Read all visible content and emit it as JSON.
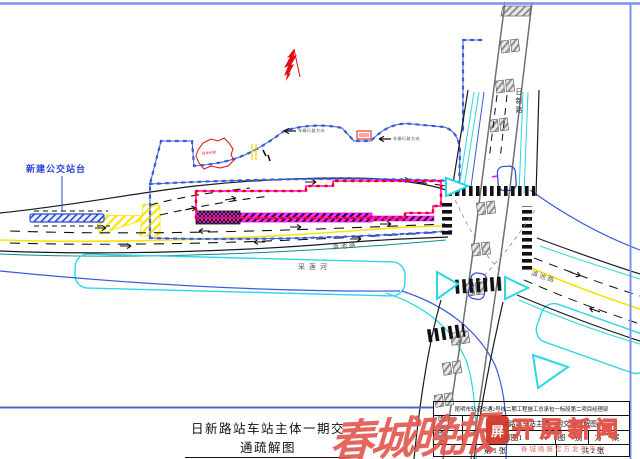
{
  "frame": {
    "border_color": "#7b93ea"
  },
  "annotations": {
    "bus_platform": "新建公交站台",
    "tree_note": "现状大树",
    "flow_note_1": "车辆行驶方向",
    "flow_note_2": "车辆行驶方向"
  },
  "roads": {
    "main_label": "滇池路",
    "diagonal_label": "滇池路",
    "vertical_label": "日新路",
    "river_label": "采莲河"
  },
  "colors": {
    "fence_blue": "#3b5bdb",
    "construction_magenta": "#ff00ff",
    "barrier_red": "#ff0000",
    "lane_yellow": "#f7e400",
    "water_cyan": "#2ad8e8",
    "road_black": "#1a1a1a",
    "bridge_gray": "#707070",
    "north_arrow_red": "#e01010"
  },
  "title": {
    "text": "日新路站车站主体一期交通疏解图"
  },
  "titleblock": {
    "company": "昆明市轨道交通2号线二期工程施工总承包一标段第二项目经理部",
    "fig_name_label": "图 名",
    "fig_name_value": "日新路站车站主体一期交通疏解图",
    "fig_no_label": "图 号",
    "fig_no_value": "疏解图1",
    "fig_type_label": "图 别",
    "fig_type_value": "方 案",
    "sheet_current": "第 1 张",
    "sheet_total": "共 2 张"
  },
  "watermark": {
    "main": "春城晚报",
    "app": "开屏新闻",
    "logo_glyph": "屏",
    "slogan": "春城晚报官方发布平台",
    "color": "#e2574d"
  }
}
